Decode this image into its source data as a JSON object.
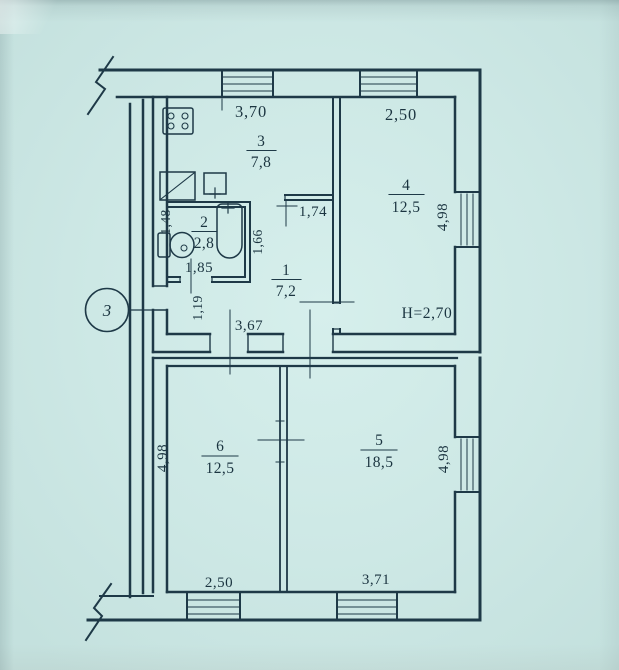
{
  "document": {
    "type": "scanned apartment floor plan",
    "colors": {
      "paper": "#cde8e5",
      "ink": "#1e3947"
    }
  },
  "plan": {
    "entrance_marker": "3",
    "height_note": "H=2,70",
    "rooms": [
      {
        "number": "1",
        "area": "7,2"
      },
      {
        "number": "2",
        "area": "2,8"
      },
      {
        "number": "3",
        "area": "7,8"
      },
      {
        "number": "4",
        "area": "12,5"
      },
      {
        "number": "5",
        "area": "18,5"
      },
      {
        "number": "6",
        "area": "12,5"
      }
    ],
    "dimensions": {
      "top_kitchen": "3,70",
      "top_room4": "2,50",
      "right_upper": "4,98",
      "hall_top": "1,74",
      "hall_side": "1,66",
      "bath_side": "1,48",
      "bath_width": "1,85",
      "entry_side": "1,19",
      "hall_width": "3,67",
      "left_lower": "4,98",
      "right_lower": "4,98",
      "bottom_room6": "2,50",
      "bottom_room5": "3,71"
    }
  }
}
